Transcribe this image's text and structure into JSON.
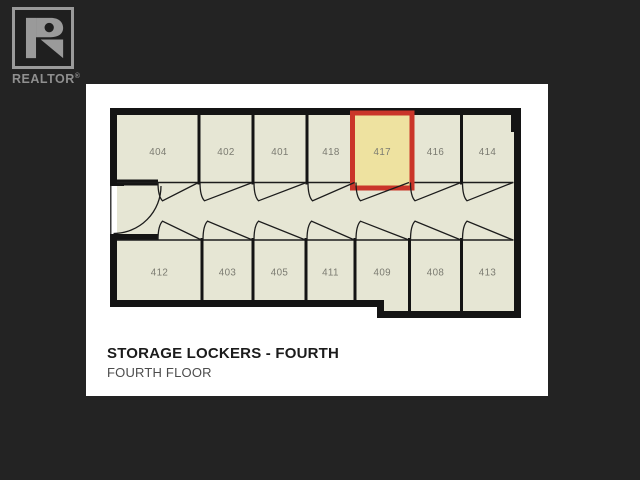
{
  "background_color": "#232323",
  "logo": {
    "text": "REALTOR",
    "reg": "®",
    "color": "#9a9a9a",
    "box_fill": "#1f1f1f"
  },
  "panel": {
    "title": "STORAGE LOCKERS - FOURTH",
    "subtitle": "FOURTH FLOOR",
    "bg": "#ffffff"
  },
  "floorplan": {
    "colors": {
      "floor": "#e6e6d4",
      "wall": "#141414",
      "line": "#1c1c1c",
      "label": "#7b7b71",
      "highlight_fill": "#eee2a0",
      "highlight_stroke": "#ca3529"
    },
    "highlighted_unit": "417",
    "interior": [
      [
        117,
        115
      ],
      [
        514,
        115
      ],
      [
        514,
        311
      ],
      [
        384,
        311
      ],
      [
        384,
        300
      ],
      [
        117,
        300
      ]
    ],
    "wall_path": "M 113.5 186 L 113.5 111.5 L 517.5 111.5 L 517.5 314.5 L 380.5 314.5 L 380.5 303.5 L 113.5 303.5 L 113.5 238.5",
    "pilaster": [
      511,
      115,
      7,
      17
    ],
    "corridor": {
      "top": 182.5,
      "bottom": 240,
      "x1": 117,
      "x2": 513.5
    },
    "entrance": {
      "gap_line": [
        110.8,
        185,
        110.8,
        239
      ],
      "nubs": [
        [
          110,
          179.5,
          14,
          6.5
        ],
        [
          110,
          234,
          14,
          6.5
        ]
      ],
      "jambs": [
        [
          117,
          179.5,
          41,
          6
        ],
        [
          117,
          234,
          41,
          6
        ]
      ],
      "arc": "M 161 186 A 47.5 47.5 0 0 1 113.5 233.5"
    },
    "top_row": [
      {
        "id": "404",
        "x1": 117,
        "x2": 199,
        "door_x0": 158
      },
      {
        "id": "402",
        "x1": 199,
        "x2": 253
      },
      {
        "id": "401",
        "x1": 253,
        "x2": 307
      },
      {
        "id": "418",
        "x1": 307,
        "x2": 355
      },
      {
        "id": "417",
        "x1": 355,
        "x2": 409.5,
        "highlight": true
      },
      {
        "id": "416",
        "x1": 409.5,
        "x2": 461.5
      },
      {
        "id": "414",
        "x1": 461.5,
        "x2": 513.5
      }
    ],
    "bottom_row": [
      {
        "id": "412",
        "x1": 117,
        "x2": 202,
        "door_x0": 158
      },
      {
        "id": "403",
        "x1": 202,
        "x2": 253
      },
      {
        "id": "405",
        "x1": 253,
        "x2": 306
      },
      {
        "id": "411",
        "x1": 306,
        "x2": 355
      },
      {
        "id": "409",
        "x1": 355,
        "x2": 409.5
      },
      {
        "id": "408",
        "x1": 409.5,
        "x2": 461.5,
        "deep": true
      },
      {
        "id": "413",
        "x1": 461.5,
        "x2": 513.5,
        "deep": true
      }
    ],
    "label_y": {
      "top": 155,
      "bottom": 275.5
    },
    "divider_bottom_y": {
      "normal": 302,
      "deep": 313
    }
  }
}
